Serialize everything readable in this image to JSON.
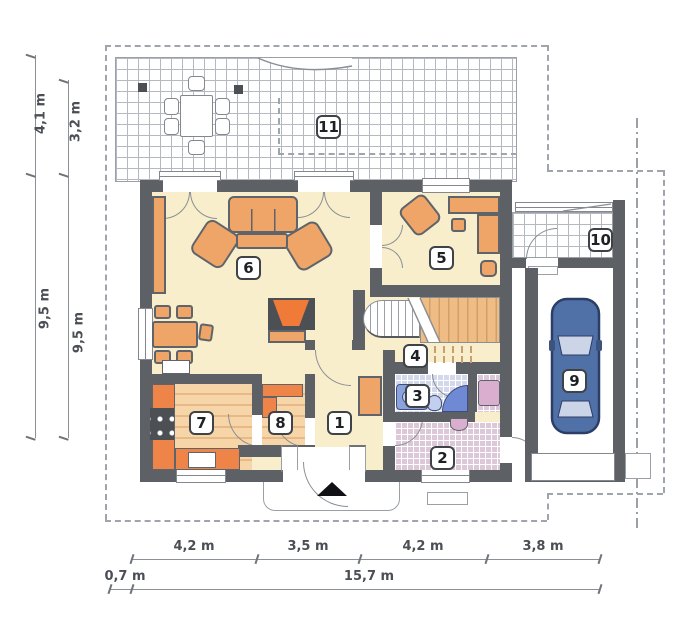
{
  "plan": {
    "type": "floor-plan",
    "rooms": [
      {
        "id": "1"
      },
      {
        "id": "2"
      },
      {
        "id": "3"
      },
      {
        "id": "4"
      },
      {
        "id": "5"
      },
      {
        "id": "6"
      },
      {
        "id": "7"
      },
      {
        "id": "8"
      },
      {
        "id": "9"
      },
      {
        "id": "10"
      },
      {
        "id": "11"
      }
    ],
    "dimensions": {
      "left_outer_top": "4,1 m",
      "left_inner_top": "3,2 m",
      "left_outer_bottom": "9,5 m",
      "left_inner_bottom": "9,5 m",
      "bottom_segments": [
        "4,2 m",
        "3,5 m",
        "4,2 m",
        "3,8 m"
      ],
      "bottom_offset": "0,7 m",
      "bottom_total": "15,7 m"
    },
    "colors": {
      "wall": "#5d6166",
      "floor": "#f8eecb",
      "wood": "#f3cd9e",
      "wood_stripe": "#e9b887",
      "furniture": "#efa468",
      "counter": "#ee8448",
      "accent_orange": "#f07a38",
      "bath_floor": "#d4d8ec",
      "vestibule_floor": "#dcc8d8",
      "fixture_blue": "#8ba3dc",
      "fixture_blue_dark": "#6f89d4",
      "washer_pink": "#d9aece",
      "car_blue": "#5070a8",
      "line": "#9aa0a6",
      "dim_text": "#4b4f55"
    }
  }
}
